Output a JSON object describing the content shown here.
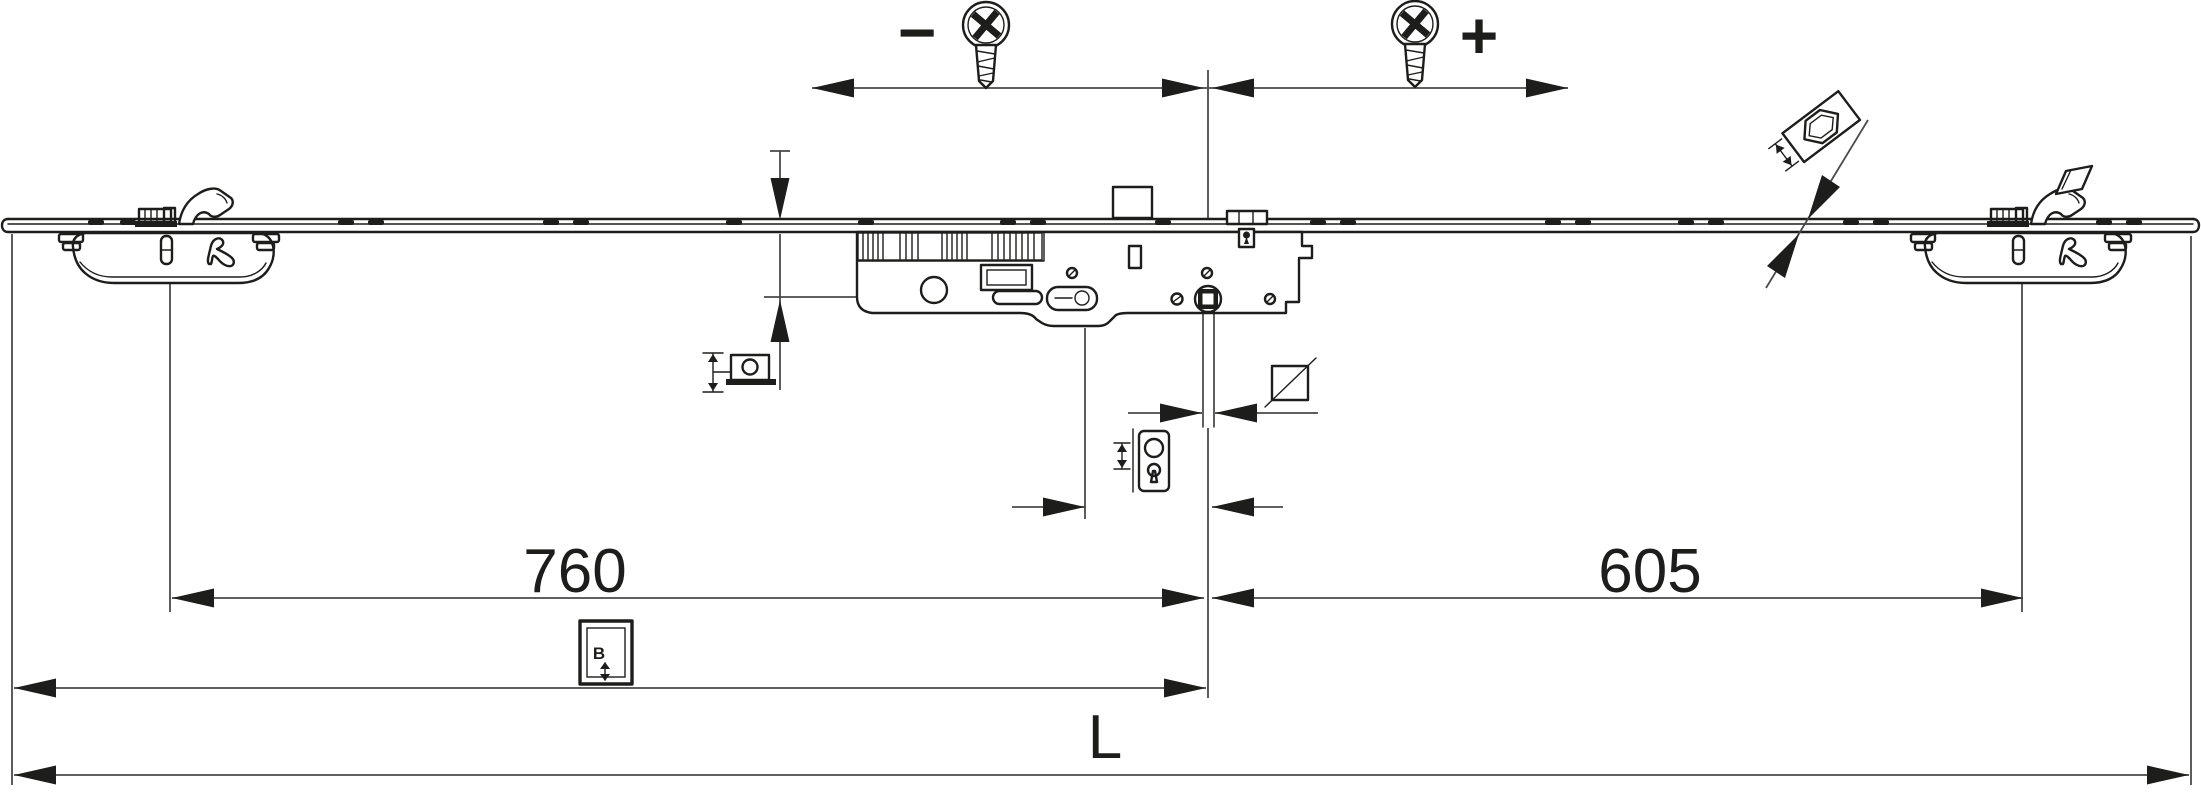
{
  "diagram": {
    "labels": {
      "dim_left": "760",
      "dim_right": "605",
      "dim_total": "L",
      "adjust_minus": "−",
      "adjust_plus": "+",
      "icon_letter_b": "B"
    },
    "colors": {
      "line": "#1d1d1b",
      "dim_line": "#4a4a48",
      "background": "#ffffff"
    },
    "icons": [
      "phillips-screw-icon",
      "mushroom-cam-icon",
      "keyhole-escutcheon-icon",
      "square-spindle-icon",
      "height-adjust-icon",
      "b-reference-icon",
      "hook-cam-icon"
    ]
  }
}
